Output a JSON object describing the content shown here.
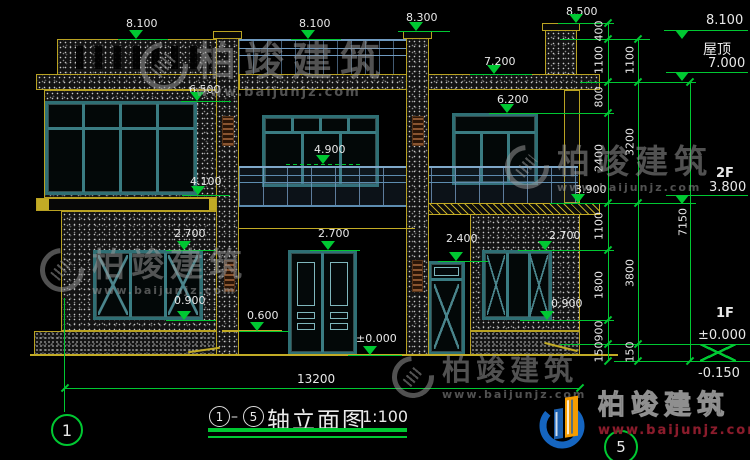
{
  "title_block": {
    "axis_start": "1",
    "axis_end": "5",
    "title": "轴立面图",
    "scale": "1:100"
  },
  "overall_width_dim": "13200",
  "axis_bubbles": {
    "left": "1",
    "right": "5"
  },
  "levels": [
    {
      "label": "8.100"
    },
    {
      "label": "8.100"
    },
    {
      "label": "8.300"
    },
    {
      "label": "8.500"
    },
    {
      "label": "7.200"
    },
    {
      "label": "6.500"
    },
    {
      "label": "6.200"
    },
    {
      "label": "4.900"
    },
    {
      "label": "4.100"
    },
    {
      "label": "3.900"
    },
    {
      "label": "2.700"
    },
    {
      "label": "2.700"
    },
    {
      "label": "2.400"
    },
    {
      "label": "2.700"
    },
    {
      "label": "0.900"
    },
    {
      "label": "0.900"
    },
    {
      "label": "0.600"
    },
    {
      "label": "±0.000"
    }
  ],
  "right_annotations": {
    "top_level": "8.100",
    "roof_label": "屋顶",
    "roof_level": "7.000",
    "f2_label": "2F",
    "f2_level": "3.800",
    "f1_label": "1F",
    "f1_level": "±0.000",
    "ground_offset": "-0.150"
  },
  "dim_chains": {
    "inner": [
      "400",
      "1100",
      "800",
      "2400",
      "1100",
      "1800",
      "900",
      "150"
    ],
    "middle": [
      "1100",
      "3200",
      "3800",
      "150"
    ],
    "outer": [
      "7150"
    ]
  },
  "watermark": {
    "name": "柏竣建筑",
    "url": "www.baijunjz.com"
  },
  "brand": {
    "name": "柏竣建筑",
    "url": "www.baijunjz.com"
  },
  "colors": {
    "dim_green": "#00c832",
    "outline_yellow": "#b9a222",
    "frame_teal": "#2f6f74",
    "railing_blue": "#6f9ac0",
    "brand_blue": "#1565c0",
    "brand_orange": "#f59c00",
    "brand_red": "#8b1c2c",
    "watermark_gray": "#9b9b9b"
  }
}
